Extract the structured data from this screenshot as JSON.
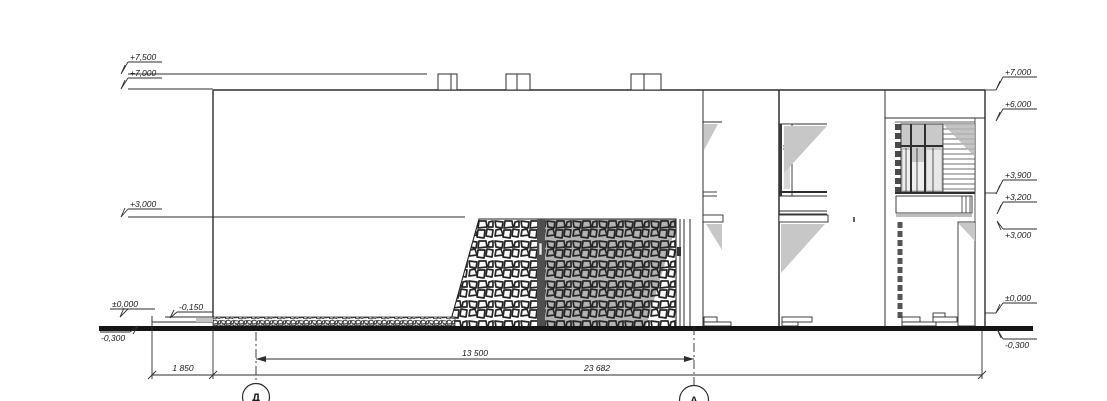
{
  "drawing": {
    "type": "architectural elevation",
    "units": "mm / m"
  },
  "levels_left": [
    {
      "label": "+7,500"
    },
    {
      "label": "+7,000"
    },
    {
      "label": "+3,000"
    },
    {
      "label": "±0,000"
    },
    {
      "label": "-0,150"
    },
    {
      "label": "-0,300"
    }
  ],
  "levels_right": [
    {
      "label": "+7,000"
    },
    {
      "label": "+6,000"
    },
    {
      "label": "+3,900"
    },
    {
      "label": "+3,200"
    },
    {
      "label": "+3,000"
    },
    {
      "label": "±0,000"
    },
    {
      "label": "-0,300"
    }
  ],
  "dimensions": [
    {
      "label": "1 850"
    },
    {
      "label": "13 500"
    },
    {
      "label": "23 682"
    }
  ],
  "axes": [
    {
      "label": "Д"
    },
    {
      "label": "А"
    }
  ],
  "colors": {
    "line": "#2e2e2e",
    "ground": "#151515",
    "shadow": "#c7c7c7",
    "screen_shadow": "#b3b3b3",
    "glazing": "#c9c9c9",
    "dark_post": "#4f4f4f"
  }
}
